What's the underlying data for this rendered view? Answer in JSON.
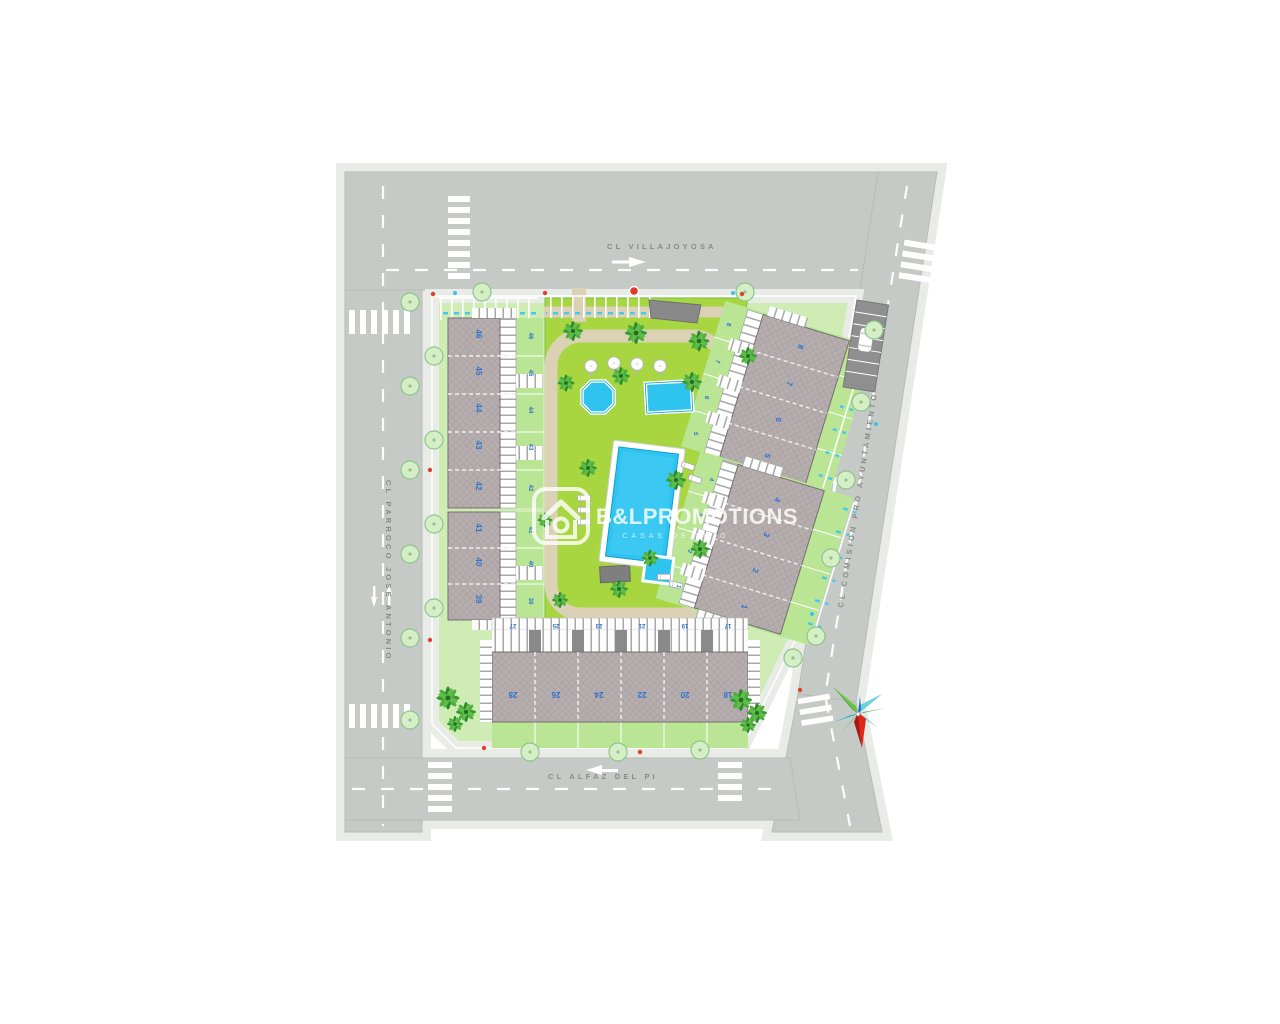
{
  "plan_title": "Residential site plan",
  "streets": {
    "top": {
      "name": "CL VILLAJOYOSA"
    },
    "left": {
      "name": "CL PARROCO JOSE ANTONIO"
    },
    "bottom": {
      "name": "CL ALFAZ DEL PI"
    },
    "right": {
      "name": "CL COMISION PRO AYUNTAMIENTO"
    }
  },
  "watermark": {
    "brand": "B&LPROMOTIONS",
    "tagline": "CASAS DE LUJO",
    "logo": "house-in-rounded-square"
  },
  "units": {
    "left_upper_roof": [
      "46",
      "45",
      "44",
      "43",
      "42"
    ],
    "left_upper_garden": [
      "46",
      "45",
      "44",
      "43",
      "42"
    ],
    "left_lower_roof": [
      "41",
      "40",
      "39"
    ],
    "left_lower_garden": [
      "41",
      "40",
      "39"
    ],
    "bottom_roof": [
      "28",
      "26",
      "24",
      "22",
      "20",
      "18"
    ],
    "bottom_terrace": [
      "27",
      "25",
      "23",
      "21",
      "19",
      "17"
    ],
    "right_upper_roof": [
      "8",
      "7",
      "6",
      "5"
    ],
    "right_upper_garden": [
      "8",
      "7",
      "6",
      "5"
    ],
    "right_lower_roof": [
      "4",
      "3",
      "2",
      "1"
    ],
    "right_lower_garden": [
      "4",
      "3",
      "2",
      "1"
    ]
  },
  "amenities": {
    "main_pool": "main swimming pool",
    "octagon_pool": "octagonal splash pool",
    "kids_pool": "rectangular kids pool",
    "compass": "compass-rose"
  },
  "colors": {
    "road": "#c6cac6",
    "sidewalk": "#e9ebe7",
    "parcel_lawn": "#cfecb4",
    "community_lawn": "#a8d640",
    "garden_green": "#b9e595",
    "roof_gray": "#b6aeae",
    "pool_cyan": "#2fc3f0",
    "unit_number_blue": "#2f72cc",
    "compass_red": "#e02818",
    "compass_green": "#2f9e2c",
    "compass_teal": "#18b2c4",
    "watermark_white": "rgba(255,255,255,0.8)"
  }
}
